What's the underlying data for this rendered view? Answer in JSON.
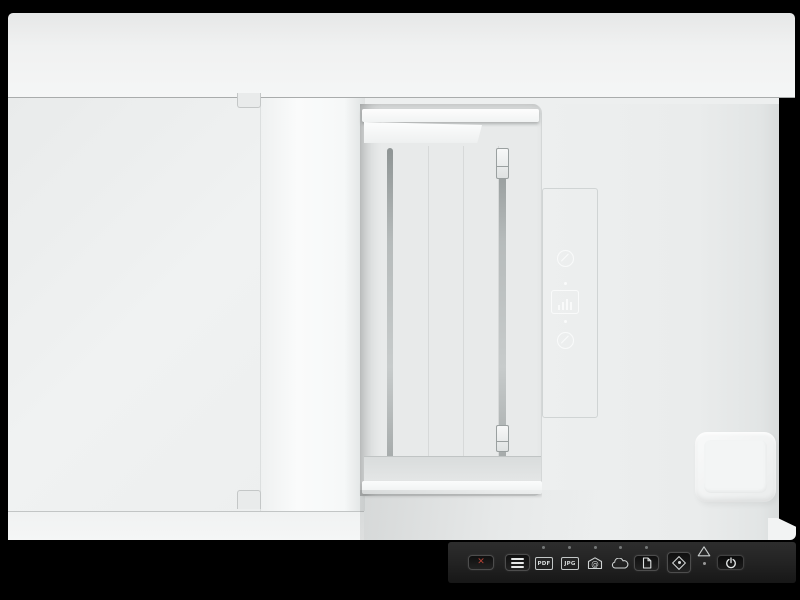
{
  "meta": {
    "description": "Top-down product photo of a white flatbed scanner with automatic document feeder on a black background"
  },
  "device": {
    "body_color": "#edefef",
    "tray_color": "#e8eaea",
    "markings": [
      {
        "name": "no-staples-marking",
        "shape": "circle-with-slash"
      },
      {
        "name": "load-original-marking",
        "shape": "document-with-bars"
      },
      {
        "name": "media-care-marking",
        "shape": "circle-with-slash"
      }
    ]
  },
  "control_panel": {
    "background": "#232323",
    "icon_color": "#cfd3d3",
    "cancel_glyph": "✕",
    "cancel_color": "#b44337",
    "labels": {
      "pdf": "PDF",
      "jpg": "JPG"
    },
    "buttons": [
      {
        "name": "cancel-button"
      },
      {
        "name": "paper-feed-button"
      },
      {
        "name": "scan-to-pdf-icon"
      },
      {
        "name": "scan-to-jpg-icon"
      },
      {
        "name": "scan-to-email-icon"
      },
      {
        "name": "scan-to-cloud-icon"
      },
      {
        "name": "scan-to-file-button"
      },
      {
        "name": "start-scan-button"
      },
      {
        "name": "power-button"
      }
    ],
    "indicator_led_count": 5,
    "has_warning_indicator": true
  }
}
